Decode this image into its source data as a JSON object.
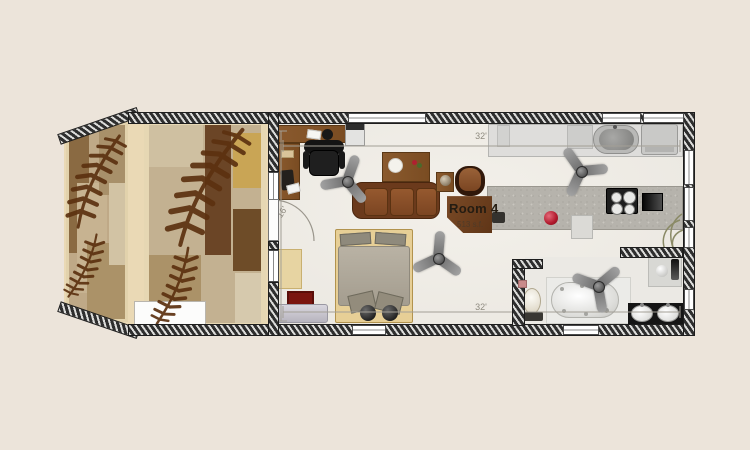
{
  "plan": {
    "room_label": {
      "name": "Room 4",
      "area": "513 s.f."
    },
    "dimensions": {
      "width_top": "32'",
      "width_bottom": "32'",
      "depth_left": "16'"
    },
    "symbols": [
      "ceiling-fan",
      "sofa",
      "armchair",
      "coffee-table",
      "side-table",
      "desk",
      "office-chair",
      "printer",
      "bed",
      "bench",
      "dresser",
      "red-rug",
      "fern-rug",
      "toilet",
      "bathtub",
      "vanity",
      "double-sink",
      "stove",
      "oven",
      "refrigerator",
      "kitchen-sink",
      "counter",
      "kettle",
      "plant",
      "door-swing",
      "window"
    ],
    "colors": {
      "background": "#ece4da",
      "floor": "#f0ede7",
      "wall_dark": "#2e2e2e",
      "wall_light": "#dcdcda",
      "deck_trim": "#ead9b5",
      "fern": "#5c3110",
      "sofa_brown": "#7a4522",
      "wood_brown": "#8a5a2e",
      "kettle_red": "#b0182b",
      "rug_red": "#7a150f"
    }
  }
}
